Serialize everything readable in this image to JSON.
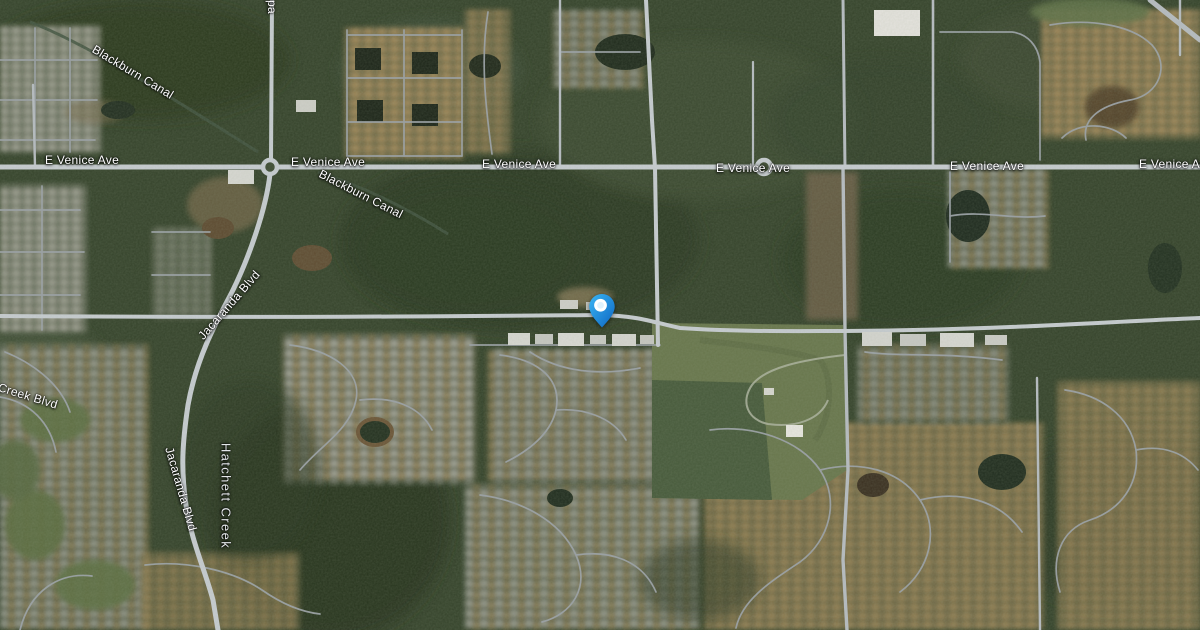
{
  "map": {
    "view": "satellite",
    "road_labels": {
      "e_venice_ave": "E Venice Ave",
      "jacaranda_blvd": "Jacaranda Blvd",
      "blackburn_canal": "Blackburn Canal",
      "creek_blvd": "Creek Blvd",
      "top_edge_partial": "pa"
    },
    "water_labels": {
      "hatchett_creek": "Hatchett Creek"
    },
    "marker": {
      "type": "location-pin",
      "color_outer_light": "#3ab5f4",
      "color_outer_dark": "#0d66c2",
      "color_inner": "#ffffff"
    },
    "palette": {
      "forest": "#35432b",
      "forest_dark": "#27331f",
      "field_olive": "#68764c",
      "field_dark": "#46593a",
      "road_gray": "#c3c8cd",
      "residential_tan": "#c9a36d",
      "pond_dark": "#1f2a1c",
      "label_text": "#ffffff"
    }
  }
}
